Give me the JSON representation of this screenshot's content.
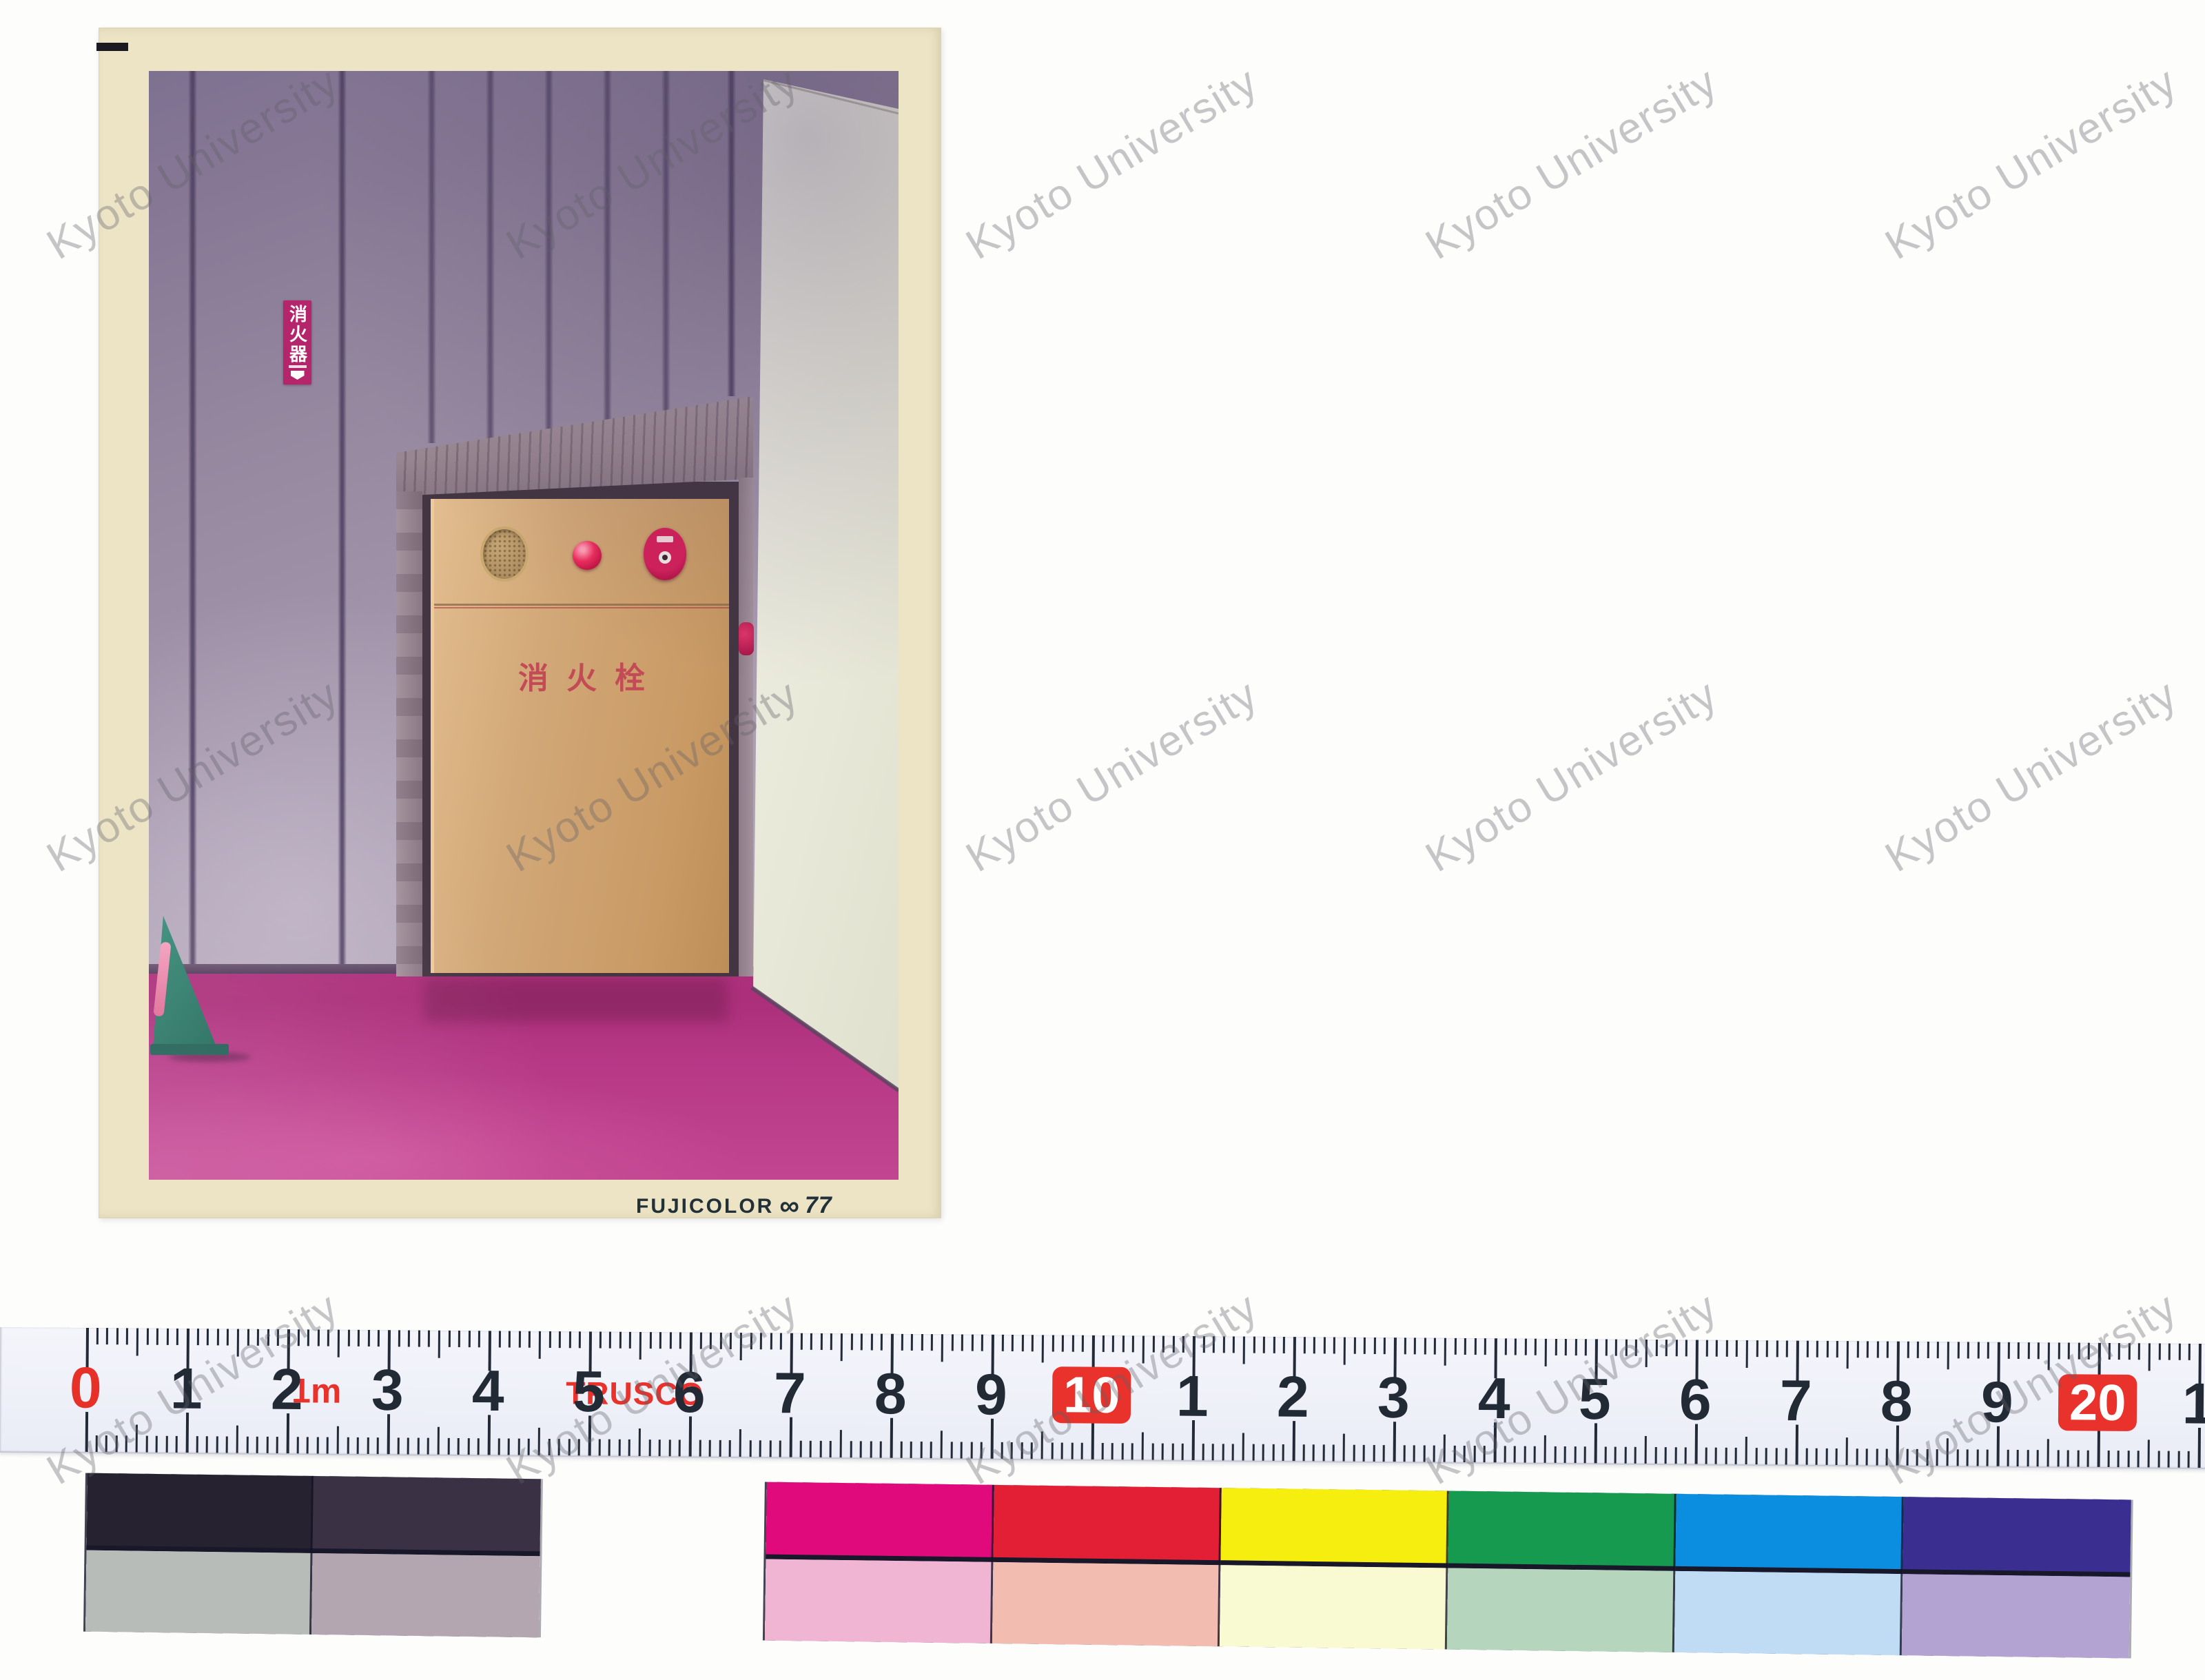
{
  "watermark": {
    "text": "Kyoto University"
  },
  "photo_print": {
    "film_brand": "FUJICOLOR",
    "film_logo_glyph": "∞",
    "film_number": "77",
    "extinguisher_sign_text": "消火器",
    "hydrant_cabinet_text": "消火栓",
    "colors": {
      "print_border": "#ece4c5",
      "wall": "#9c8da6",
      "wall_groove": "#5f5170",
      "bright_wall": "#eceadf",
      "floor_magenta": "#b23380",
      "alcove_frame": "#97858f",
      "cabinet_cream": "#d2a878",
      "alarm_red": "#cf1955",
      "sign_red": "#b4256c",
      "stand_teal": "#2a7d6d"
    }
  },
  "ruler": {
    "brand": "TRUSCO",
    "meter_label": "1m",
    "labels": [
      {
        "text": "0",
        "variant": "red"
      },
      {
        "text": "1",
        "variant": "plain"
      },
      {
        "text": "2",
        "variant": "plain"
      },
      {
        "text": "3",
        "variant": "plain"
      },
      {
        "text": "4",
        "variant": "plain"
      },
      {
        "text": "5",
        "variant": "plain"
      },
      {
        "text": "6",
        "variant": "plain"
      },
      {
        "text": "7",
        "variant": "plain"
      },
      {
        "text": "8",
        "variant": "plain"
      },
      {
        "text": "9",
        "variant": "plain"
      },
      {
        "text": "10",
        "variant": "boxed"
      },
      {
        "text": "1",
        "variant": "plain"
      },
      {
        "text": "2",
        "variant": "plain"
      },
      {
        "text": "3",
        "variant": "plain"
      },
      {
        "text": "4",
        "variant": "plain"
      },
      {
        "text": "5",
        "variant": "plain"
      },
      {
        "text": "6",
        "variant": "plain"
      },
      {
        "text": "7",
        "variant": "plain"
      },
      {
        "text": "8",
        "variant": "plain"
      },
      {
        "text": "9",
        "variant": "plain"
      },
      {
        "text": "20",
        "variant": "boxed"
      },
      {
        "text": "1",
        "variant": "plain"
      }
    ],
    "colors": {
      "tape": "#eef0f7",
      "tick": "#222a38",
      "accent_red": "#e8322b"
    }
  },
  "color_chart": {
    "columns": [
      {
        "top": "#262230",
        "bottom": "#b7bcb8"
      },
      {
        "top": "#3a3244",
        "bottom": "#b3a6b1"
      },
      {
        "top": "#e00a7c",
        "bottom": "#efb5d2"
      },
      {
        "top": "#e31f36",
        "bottom": "#f3bcb0"
      },
      {
        "top": "#f5ee0f",
        "bottom": "#fafad2"
      },
      {
        "top": "#169a50",
        "bottom": "#b5d6bd"
      },
      {
        "top": "#0c8ee0",
        "bottom": "#c0dcf5"
      },
      {
        "top": "#3a2f90",
        "bottom": "#b3a3d2"
      }
    ]
  }
}
